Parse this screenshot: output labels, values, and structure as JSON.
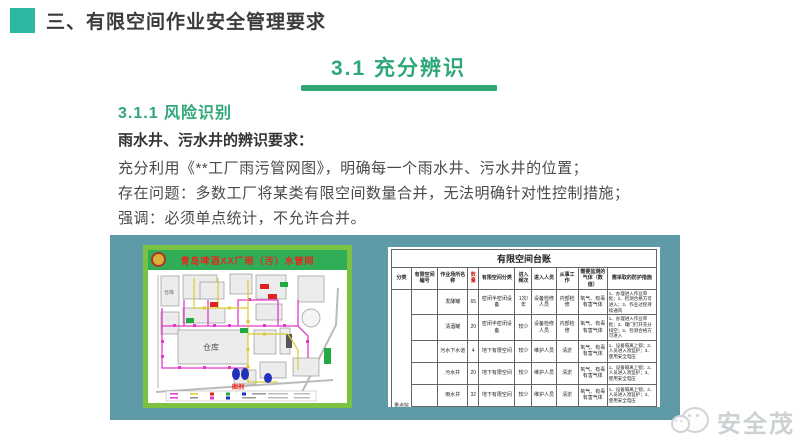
{
  "header": {
    "title": "三、有限空间作业安全管理要求"
  },
  "section": {
    "heading": "3.1  充分辨识"
  },
  "subsection": {
    "heading": "3.1.1  风险识别",
    "lead": "雨水井、污水井的辨识要求：",
    "lines": [
      "充分利用《**工厂雨污管网图》，明确每一个雨水井、污水井的位置；",
      "存在问题：多数工厂将某类有限空间数量合并，无法明确针对性控制措施；",
      "强调：必须单点统计，不允许合并。"
    ]
  },
  "figure": {
    "map": {
      "title": "青岛啤酒XX厂雨（污）水管网",
      "legend_label": "图例",
      "building_labels": [
        "仓库",
        "仓库"
      ]
    },
    "table": {
      "title": "有限空间台账",
      "headers": [
        "分类",
        "有限空间编号",
        "作业场所名称",
        "数量",
        "有限空间分类",
        "进入频次",
        "进入人员",
        "从事工作",
        "需要监测的气体（数值）",
        "需采取的防护措施"
      ],
      "category_label": "重点监控有限空间",
      "rows": [
        [
          "发酵罐",
          "65",
          "密闭半密闭设备",
          "1次/年",
          "设备检修人员",
          "内部检修",
          "氧气、有毒有害气体",
          "1、办理进入作业审批；2、检测合格方可进入；3、作业过程持续通风"
        ],
        [
          "清酒罐",
          "20",
          "密闭半密闭设备",
          "较少",
          "设备检修人员",
          "内部检修",
          "氧气、有毒有害气体",
          "1、办理进入作业审批；2、罐门打开充分排空；3、检测合格方可进入"
        ],
        [
          "污水下水道",
          "4",
          "地下有限空间",
          "较少",
          "维护人员",
          "清淤",
          "氧气、有毒有害气体",
          "1、设备隔离上锁；2、人员进入须监护；3、使用安全电压"
        ],
        [
          "污水井",
          "20",
          "地下有限空间",
          "较少",
          "维护人员",
          "清淤",
          "氧气、有毒有害气体",
          "1、设备隔离上锁；2、人员进入须监护；3、使用安全电压"
        ],
        [
          "雨水井",
          "32",
          "地下有限空间",
          "较少",
          "维护人员",
          "清淤",
          "氧气、有毒有害气体",
          "1、设备隔离上锁；2、人员进入须监护；3、使用安全电压"
        ],
        [
          "集水池",
          "2",
          "地下有限空间",
          "较少",
          "维护人员",
          "清淤",
          "氧气、有毒有害气体",
          "1、设备隔离上锁；2、人员进入须监护；3、使用安全电压"
        ]
      ]
    }
  },
  "watermark": {
    "label": "安全茂"
  },
  "colors": {
    "accent_teal": "#2cb7a0",
    "heading_green": "#2fa779",
    "panel_teal": "#5f9aa8",
    "map_border_green": "#7cc242",
    "map_header_green": "#2fae57",
    "map_title_red": "#e8251f",
    "qty_header_red": "#d02a1e",
    "watermark_gray": "#ccd1d3"
  }
}
